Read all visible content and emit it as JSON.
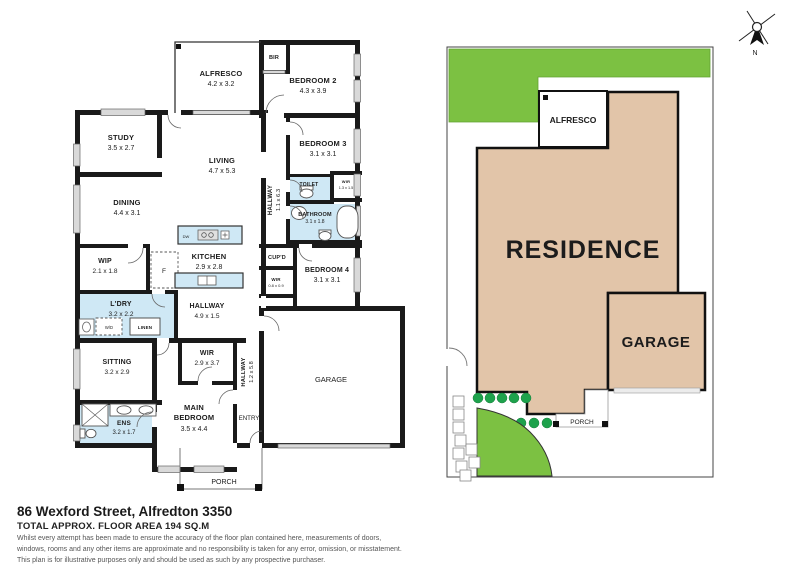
{
  "floor_plan": {
    "rooms": {
      "alfresco": {
        "name": "ALFRESCO",
        "dims": "4.2 x 3.2"
      },
      "bir": {
        "name": "BIR"
      },
      "bedroom2": {
        "name": "BEDROOM 2",
        "dims": "4.3 x 3.9"
      },
      "study": {
        "name": "STUDY",
        "dims": "3.5 x 2.7"
      },
      "living": {
        "name": "LIVING",
        "dims": "4.7 x 5.3"
      },
      "dining": {
        "name": "DINING",
        "dims": "4.4 x 3.1"
      },
      "bedroom3": {
        "name": "BEDROOM 3",
        "dims": "3.1 x 3.1"
      },
      "hallway_upper": {
        "name": "HALLWAY",
        "dims": "1.1 x 6.3"
      },
      "toilet": {
        "name": "TOILET"
      },
      "wir_small": {
        "name": "WIR",
        "dims": "1.3 x 1.5"
      },
      "bathroom": {
        "name": "BATHROOM",
        "dims": "3.1 x 1.8"
      },
      "wip": {
        "name": "WIP",
        "dims": "2.1 x 1.8"
      },
      "fridge": {
        "name": "F"
      },
      "kitchen": {
        "name": "KITCHEN",
        "dims": "2.9 x 2.8"
      },
      "dishwasher": {
        "name": "DW"
      },
      "cupd": {
        "name": "CUP'D"
      },
      "wir_hall": {
        "name": "WIR",
        "dims": "0.8 x 0.9"
      },
      "bedroom4": {
        "name": "BEDROOM 4",
        "dims": "3.1 x 3.1"
      },
      "laundry": {
        "name": "L'DRY",
        "dims": "3.2 x 2.2"
      },
      "wd": {
        "name": "W/D"
      },
      "linen": {
        "name": "LINEN"
      },
      "hallway_mid": {
        "name": "HALLWAY",
        "dims": "4.9 x 1.5"
      },
      "sitting": {
        "name": "SITTING",
        "dims": "3.2 x 2.9"
      },
      "wir_main": {
        "name": "WIR",
        "dims": "2.9 x 3.7"
      },
      "main_bedroom": {
        "line1": "MAIN",
        "line2": "BEDROOM",
        "dims": "3.5 x 4.4"
      },
      "ens": {
        "name": "ENS",
        "dims": "3.2 x 1.7"
      },
      "hallway_entry": {
        "name": "HALLWAY",
        "dims": "1.2 x 5.8"
      },
      "garage": {
        "name": "GARAGE"
      },
      "entry": {
        "name": "ENTRY"
      },
      "porch": {
        "name": "PORCH"
      }
    }
  },
  "site_plan": {
    "residence": "RESIDENCE",
    "garage": "GARAGE",
    "alfresco": "ALFRESCO",
    "porch": "PORCH"
  },
  "compass": {
    "north_label": "N"
  },
  "footer": {
    "address": "86 Wexford Street, Alfredton 3350",
    "area": "TOTAL APPROX. FLOOR AREA 194 SQ.M",
    "disclaimer_lines": [
      "Whilst every attempt has been made to ensure the accuracy of the floor plan contained here, measurements of doors,",
      "windows, rooms and any other items are approximate and no responsibility is taken for any error, omission, or misstatement.",
      "This plan is for illustrative purposes only and should be used as such by any prospective purchaser."
    ]
  },
  "colors": {
    "wall": "#1a1a1a",
    "wet_area": "#cfe8f5",
    "window_fill": "#d9d9d9",
    "lawn": "#7cc142",
    "shrub": "#1ea24c",
    "residence_fill": "#e2c5a9"
  }
}
